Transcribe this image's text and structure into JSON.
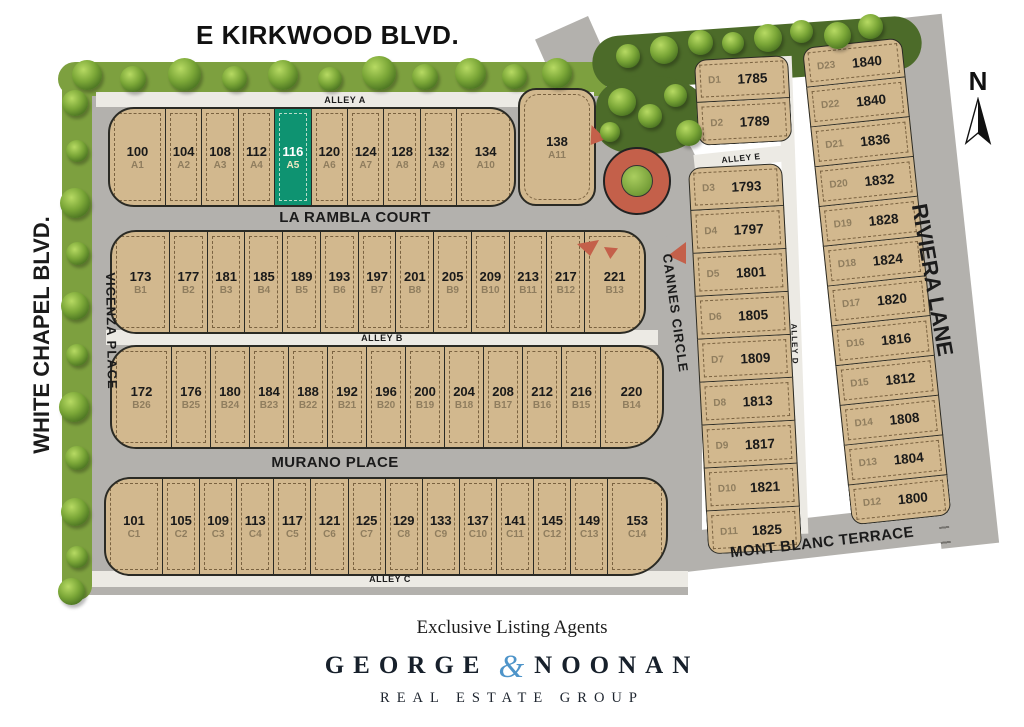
{
  "colors": {
    "highlight-lot": "#0E9371",
    "ampersand-blue": "#4E94C9"
  },
  "map": {
    "title": "E KIRKWOOD BLVD.",
    "compass_label": "N",
    "streets": {
      "white_chapel": "WHITE CHAPEL BLVD.",
      "riviera": "RIVIERA LANE",
      "la_rambla": "LA RAMBLA COURT",
      "murano": "MURANO PLACE",
      "vicenza": "VICENZA PLACE",
      "cannes": "CANNES CIRCLE",
      "mont_blanc": "MONT BLANC TERRACE",
      "alley_a": "ALLEY A",
      "alley_b": "ALLEY B",
      "alley_c": "ALLEY C",
      "alley_d": "ALLEY D",
      "alley_e": "ALLEY E"
    },
    "lots": {
      "row_a": [
        {
          "num": "100",
          "id": "A1"
        },
        {
          "num": "104",
          "id": "A2"
        },
        {
          "num": "108",
          "id": "A3"
        },
        {
          "num": "112",
          "id": "A4"
        },
        {
          "num": "116",
          "id": "A5",
          "highlight": true
        },
        {
          "num": "120",
          "id": "A6"
        },
        {
          "num": "124",
          "id": "A7"
        },
        {
          "num": "128",
          "id": "A8"
        },
        {
          "num": "132",
          "id": "A9"
        },
        {
          "num": "134",
          "id": "A10"
        }
      ],
      "lot_138": {
        "num": "138",
        "id": "A11"
      },
      "row_b_upper": [
        {
          "num": "173",
          "id": "B1"
        },
        {
          "num": "177",
          "id": "B2"
        },
        {
          "num": "181",
          "id": "B3"
        },
        {
          "num": "185",
          "id": "B4"
        },
        {
          "num": "189",
          "id": "B5"
        },
        {
          "num": "193",
          "id": "B6"
        },
        {
          "num": "197",
          "id": "B7"
        },
        {
          "num": "201",
          "id": "B8"
        },
        {
          "num": "205",
          "id": "B9"
        },
        {
          "num": "209",
          "id": "B10"
        },
        {
          "num": "213",
          "id": "B11"
        },
        {
          "num": "217",
          "id": "B12"
        },
        {
          "num": "221",
          "id": "B13"
        }
      ],
      "row_b_lower": [
        {
          "num": "172",
          "id": "B26"
        },
        {
          "num": "176",
          "id": "B25"
        },
        {
          "num": "180",
          "id": "B24"
        },
        {
          "num": "184",
          "id": "B23"
        },
        {
          "num": "188",
          "id": "B22"
        },
        {
          "num": "192",
          "id": "B21"
        },
        {
          "num": "196",
          "id": "B20"
        },
        {
          "num": "200",
          "id": "B19"
        },
        {
          "num": "204",
          "id": "B18"
        },
        {
          "num": "208",
          "id": "B17"
        },
        {
          "num": "212",
          "id": "B16"
        },
        {
          "num": "216",
          "id": "B15"
        },
        {
          "num": "220",
          "id": "B14"
        }
      ],
      "row_c": [
        {
          "num": "101",
          "id": "C1"
        },
        {
          "num": "105",
          "id": "C2"
        },
        {
          "num": "109",
          "id": "C3"
        },
        {
          "num": "113",
          "id": "C4"
        },
        {
          "num": "117",
          "id": "C5"
        },
        {
          "num": "121",
          "id": "C6"
        },
        {
          "num": "125",
          "id": "C7"
        },
        {
          "num": "129",
          "id": "C8"
        },
        {
          "num": "133",
          "id": "C9"
        },
        {
          "num": "137",
          "id": "C10"
        },
        {
          "num": "141",
          "id": "C11"
        },
        {
          "num": "145",
          "id": "C12"
        },
        {
          "num": "149",
          "id": "C13"
        },
        {
          "num": "153",
          "id": "C14"
        }
      ],
      "d_left_upper": [
        {
          "id": "D1",
          "num": "1785"
        },
        {
          "id": "D2",
          "num": "1789"
        }
      ],
      "d_left_lower": [
        {
          "id": "D3",
          "num": "1793"
        },
        {
          "id": "D4",
          "num": "1797"
        },
        {
          "id": "D5",
          "num": "1801"
        },
        {
          "id": "D6",
          "num": "1805"
        },
        {
          "id": "D7",
          "num": "1809"
        },
        {
          "id": "D8",
          "num": "1813"
        },
        {
          "id": "D9",
          "num": "1817"
        },
        {
          "id": "D10",
          "num": "1821"
        },
        {
          "id": "D11",
          "num": "1825"
        }
      ],
      "d_right": [
        {
          "id": "D23",
          "num": "1840"
        },
        {
          "id": "D22",
          "num": "1840"
        },
        {
          "id": "D21",
          "num": "1836"
        },
        {
          "id": "D20",
          "num": "1832"
        },
        {
          "id": "D19",
          "num": "1828"
        },
        {
          "id": "D18",
          "num": "1824"
        },
        {
          "id": "D17",
          "num": "1820"
        },
        {
          "id": "D16",
          "num": "1816"
        },
        {
          "id": "D15",
          "num": "1812"
        },
        {
          "id": "D14",
          "num": "1808"
        },
        {
          "id": "D13",
          "num": "1804"
        },
        {
          "id": "D12",
          "num": "1800"
        }
      ]
    }
  },
  "footer": {
    "tagline": "Exclusive Listing Agents",
    "brand_first": "GEORGE",
    "brand_amp": "&",
    "brand_last": "NOONAN",
    "brand_sub": "REAL ESTATE GROUP"
  }
}
